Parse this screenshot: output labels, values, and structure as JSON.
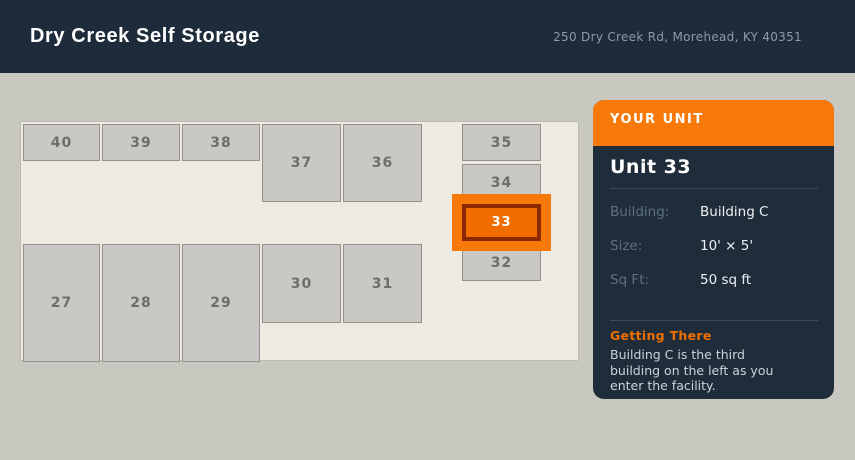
{
  "header": {
    "title": "Dry Creek Self Storage",
    "address": "250 Dry Creek Rd, Morehead, KY 40351"
  },
  "map": {
    "units": [
      {
        "label": "40",
        "x": 2,
        "y": 2,
        "w": 77,
        "h": 37,
        "highlighted": false
      },
      {
        "label": "39",
        "x": 81,
        "y": 2,
        "w": 78,
        "h": 37,
        "highlighted": false
      },
      {
        "label": "38",
        "x": 161,
        "y": 2,
        "w": 78,
        "h": 37,
        "highlighted": false
      },
      {
        "label": "37",
        "x": 241,
        "y": 2,
        "w": 79,
        "h": 78,
        "highlighted": false
      },
      {
        "label": "36",
        "x": 322,
        "y": 2,
        "w": 79,
        "h": 78,
        "highlighted": false
      },
      {
        "label": "35",
        "x": 441,
        "y": 2,
        "w": 79,
        "h": 37,
        "highlighted": false
      },
      {
        "label": "34",
        "x": 441,
        "y": 42,
        "w": 79,
        "h": 37,
        "highlighted": false
      },
      {
        "label": "33",
        "x": 441,
        "y": 82,
        "w": 79,
        "h": 37,
        "highlighted": true
      },
      {
        "label": "32",
        "x": 441,
        "y": 122,
        "w": 79,
        "h": 37,
        "highlighted": false
      },
      {
        "label": "27",
        "x": 2,
        "y": 122,
        "w": 77,
        "h": 118,
        "highlighted": false
      },
      {
        "label": "28",
        "x": 81,
        "y": 122,
        "w": 78,
        "h": 118,
        "highlighted": false
      },
      {
        "label": "29",
        "x": 161,
        "y": 122,
        "w": 78,
        "h": 118,
        "highlighted": false
      },
      {
        "label": "30",
        "x": 241,
        "y": 122,
        "w": 79,
        "h": 79,
        "highlighted": false
      },
      {
        "label": "31",
        "x": 322,
        "y": 122,
        "w": 79,
        "h": 79,
        "highlighted": false
      }
    ]
  },
  "panel": {
    "header_label": "YOUR UNIT",
    "title": "Unit 33",
    "details": [
      {
        "label": "Building:",
        "value": "Building C"
      },
      {
        "label": "Size:",
        "value": "10' × 5'"
      },
      {
        "label": "Sq Ft:",
        "value": "50 sq ft"
      }
    ],
    "directions_title": "Getting There",
    "directions_text": "Building C is the third building on the left as you enter the facility."
  },
  "colors": {
    "accent_orange": "#f7790a",
    "highlight_fill": "#f26d00",
    "highlight_border": "#8b2900",
    "header_navy": "#1d2b3a",
    "panel_navy": "#1f2c3a",
    "page_bg": "#c9c8c0",
    "map_bg": "#edeae2",
    "unit_fill": "#c9c8c5",
    "unit_border": "#93928d"
  }
}
